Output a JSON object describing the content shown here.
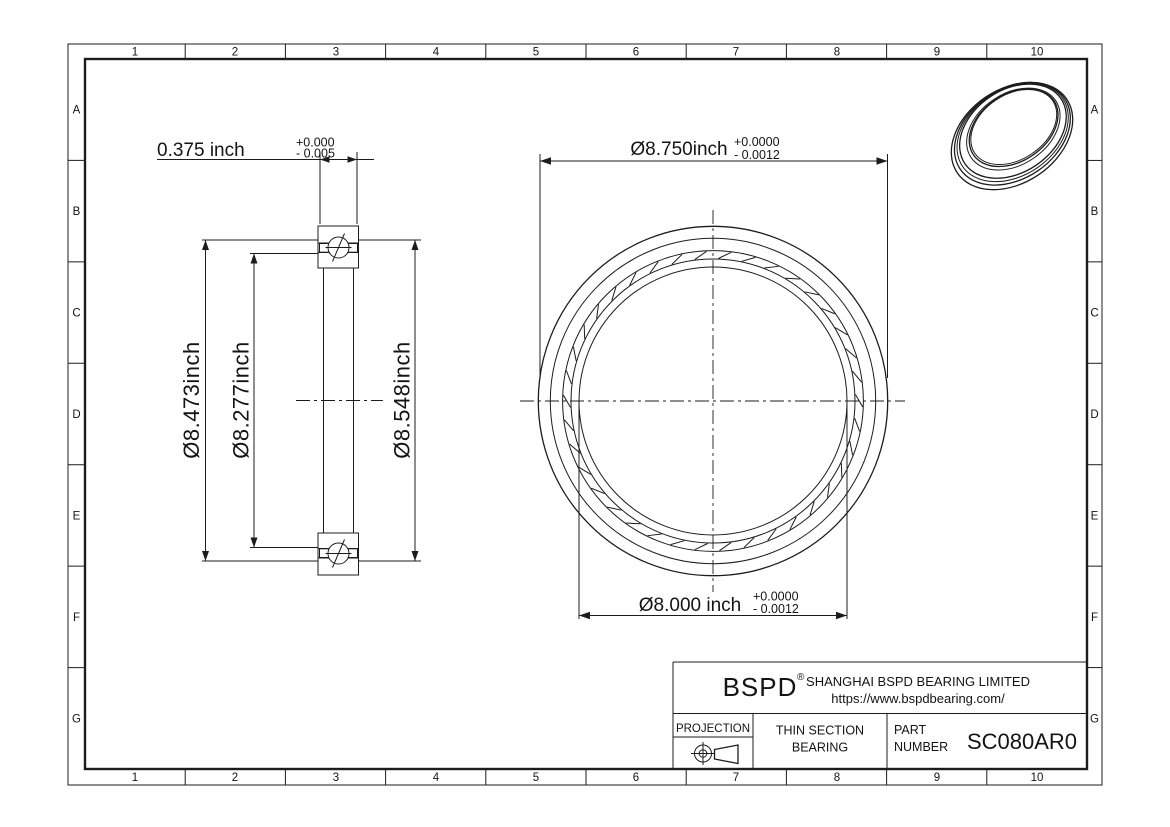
{
  "grid": {
    "cols": [
      "1",
      "2",
      "3",
      "4",
      "5",
      "6",
      "7",
      "8",
      "9",
      "10"
    ],
    "rows": [
      "A",
      "B",
      "C",
      "D",
      "E",
      "F",
      "G"
    ]
  },
  "dims": {
    "width": {
      "value": "0.375 inch",
      "tol_plus": "+0.000",
      "tol_minus": "- 0.005"
    },
    "od": {
      "value": "Ø8.750inch",
      "tol_plus": "+0.0000",
      "tol_minus": "- 0.0012"
    },
    "bore": {
      "value": "Ø8.000 inch",
      "tol_plus": "+0.0000",
      "tol_minus": "- 0.0012"
    },
    "race_left": "Ø8.473inch",
    "race_inner": "Ø8.277inch",
    "race_outer": "Ø8.548inch"
  },
  "title_block": {
    "logo": "BSPD",
    "registered": "®",
    "company": "SHANGHAI BSPD BEARING LIMITED",
    "website": "https://www.bspdbearing.com/",
    "projection_label": "PROJECTION",
    "product_line1": "THIN SECTION",
    "product_line2": "BEARING",
    "part_label_line1": "PART",
    "part_label_line2": "NUMBER",
    "part_number": "SC080AR0"
  },
  "colors": {
    "line": "#1c1c1c",
    "background": "#ffffff"
  }
}
